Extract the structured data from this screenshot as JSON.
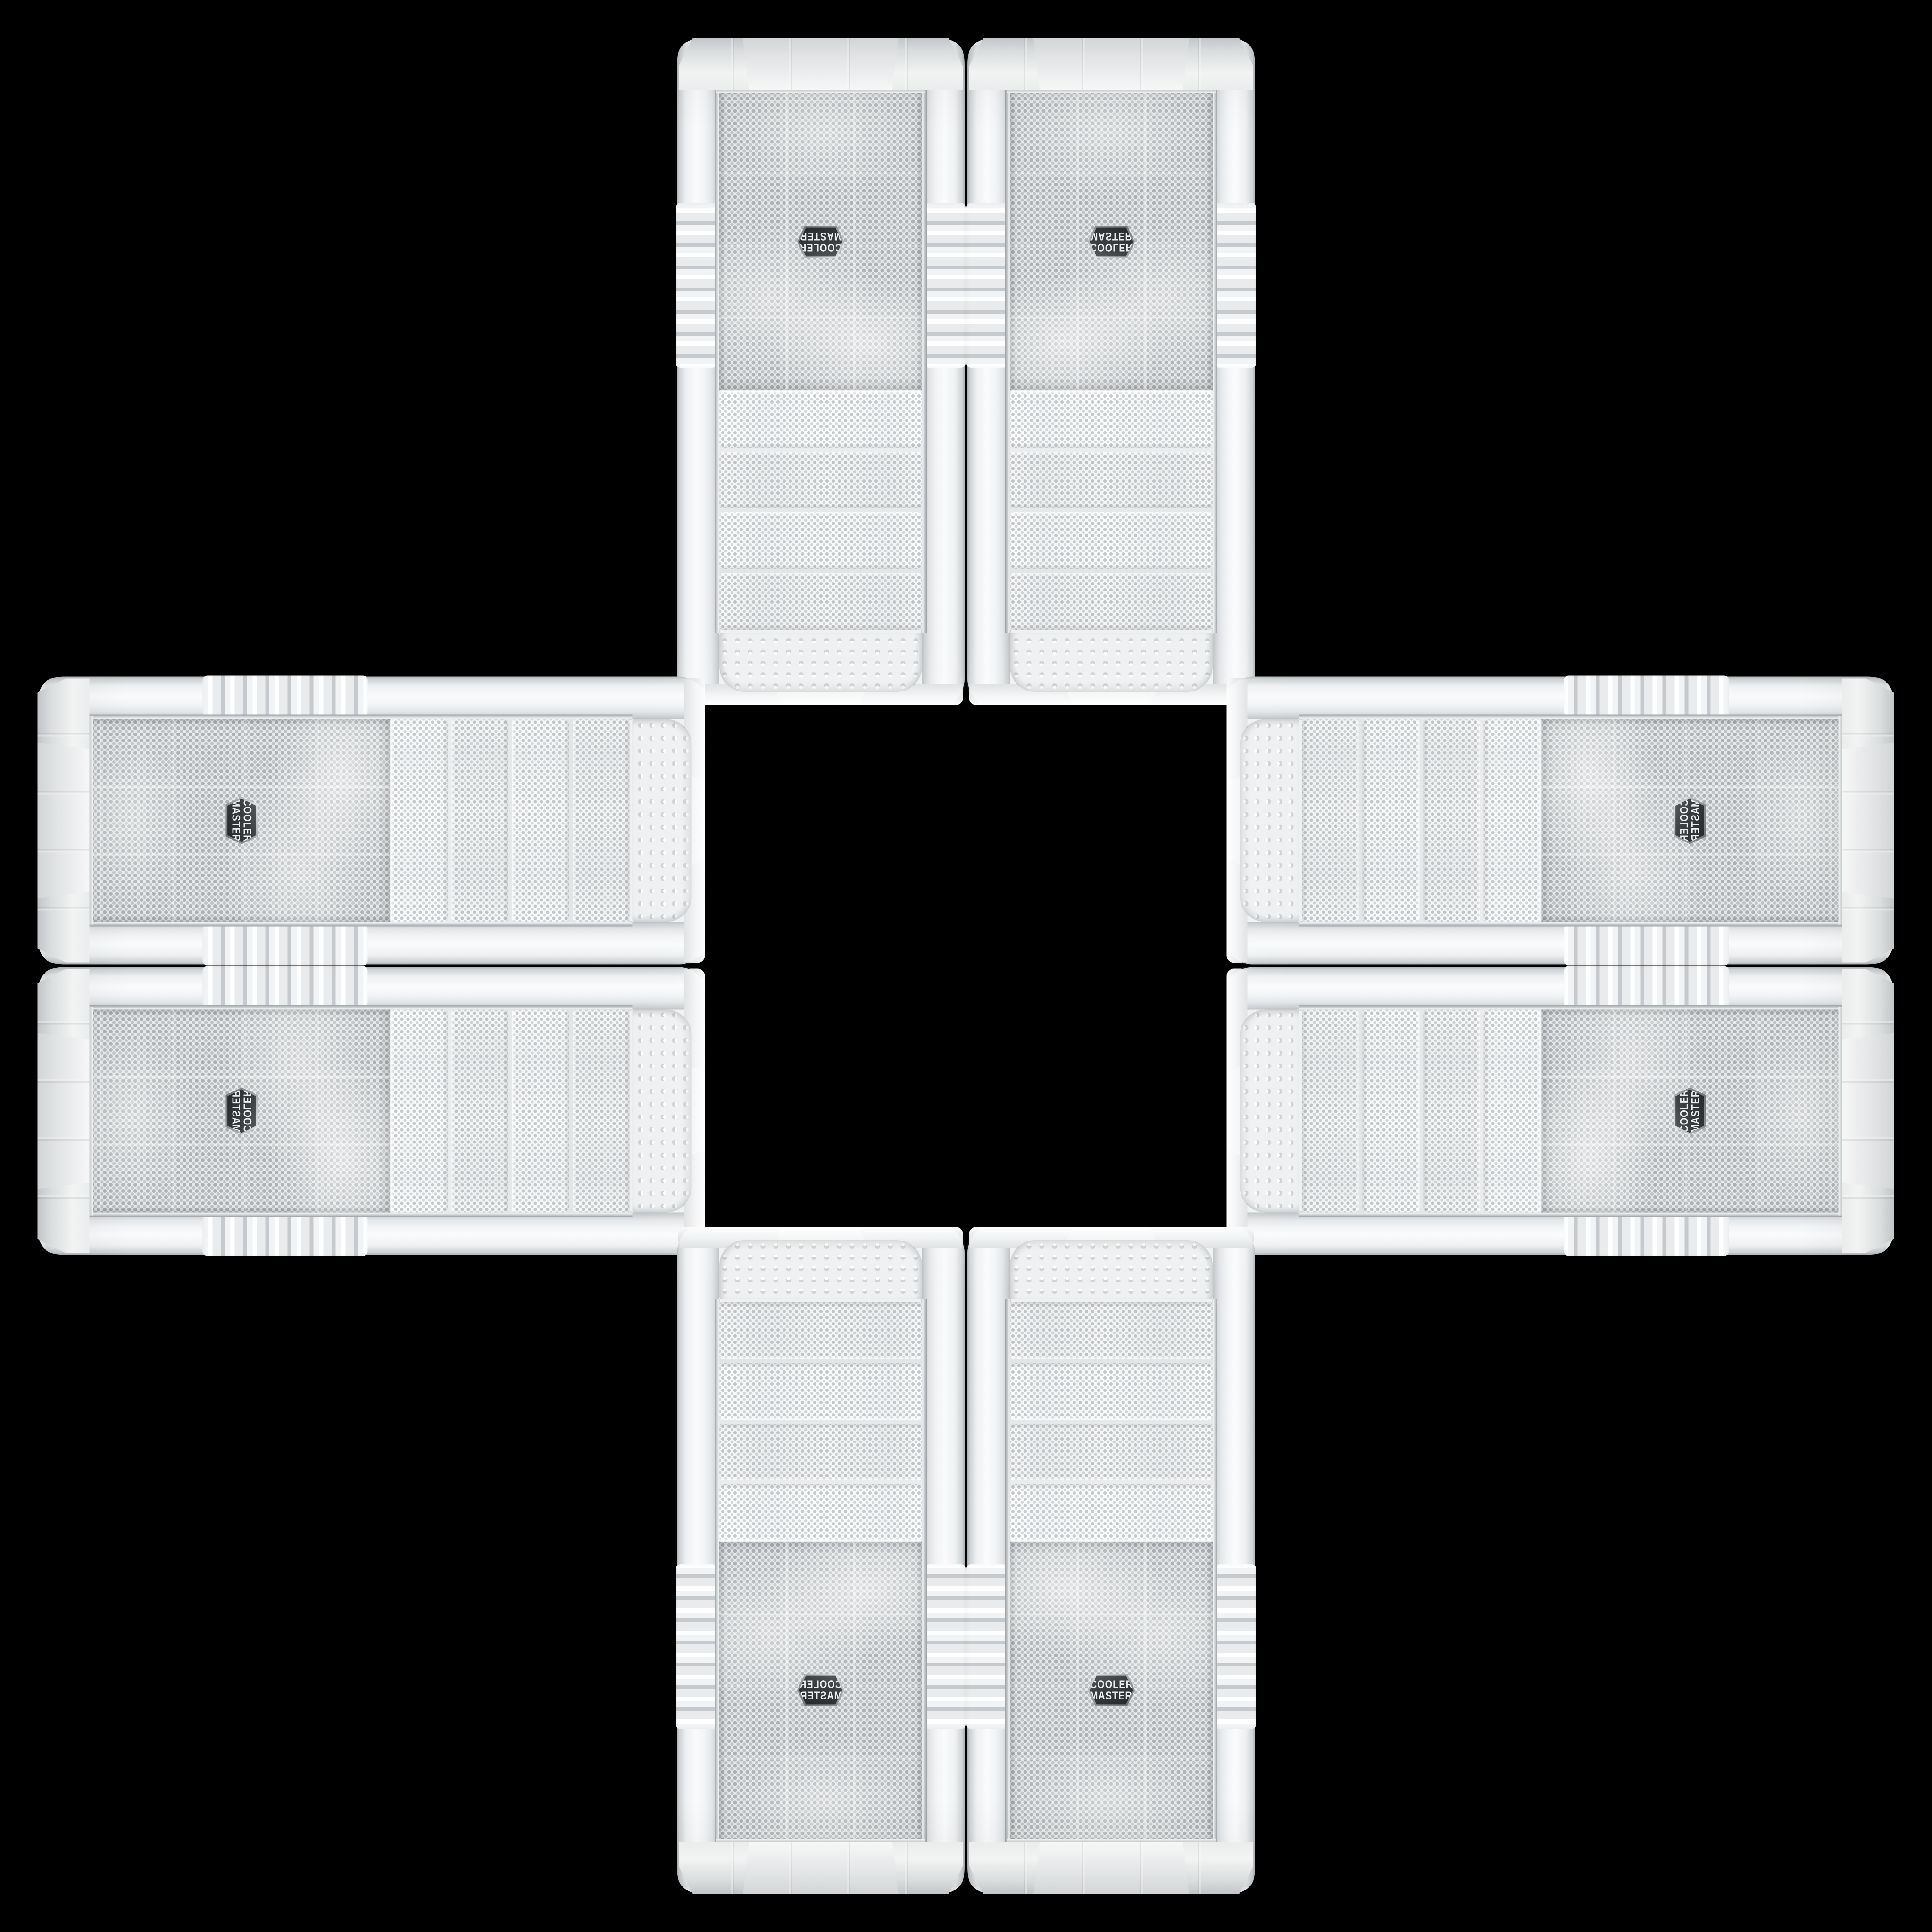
{
  "scene": {
    "title": "Cooler Master white PC tower cases montage",
    "description": "Eight identical white Cooler Master mid-tower front panels arranged in a plus/cross pattern on a black background; each instance is a rotation or mirror of the same product photo, with an empty black square at the center.",
    "background_color": "#000000",
    "brand": {
      "line1": "COOLER",
      "line2": "MASTER"
    },
    "badge": {
      "shape": "hexagon",
      "background": "#33373a",
      "text_color": "#e9eced",
      "rim_color": "#9a9fa2"
    },
    "palette": {
      "case_white": "#f2f3f4",
      "rail_shade": "#c8cccf",
      "mesh_base": "#e7e9ea",
      "mesh_dot": "#adb1b4",
      "strip_base": "#edeff0",
      "strip_dot": "#c0c4c6",
      "bump_base": "#eef0f1",
      "trim_silver": "#ced2d4",
      "background": "#000000"
    },
    "arrangement": "plus-cross, 4-fold mirror symmetry, hollow center",
    "cases": [
      {
        "id": "case-top-left",
        "orientation": "vertical, rotated 180deg, logo upside-down near top"
      },
      {
        "id": "case-top-right",
        "orientation": "vertical, flipped vertically, mirror of top-left"
      },
      {
        "id": "case-left-upper",
        "orientation": "horizontal, rotated 90deg cw, logo at left end"
      },
      {
        "id": "case-left-lower",
        "orientation": "horizontal, rotated 90deg cw and mirrored, logo at left end"
      },
      {
        "id": "case-right-upper",
        "orientation": "horizontal, transposed, logo at right end"
      },
      {
        "id": "case-right-lower",
        "orientation": "horizontal, rotated 90deg ccw, logo at right end"
      },
      {
        "id": "case-bottom-left",
        "orientation": "vertical, mirrored horizontally, logo readable near bottom"
      },
      {
        "id": "case-bottom-right",
        "orientation": "vertical, upright original, logo readable near bottom"
      }
    ]
  }
}
